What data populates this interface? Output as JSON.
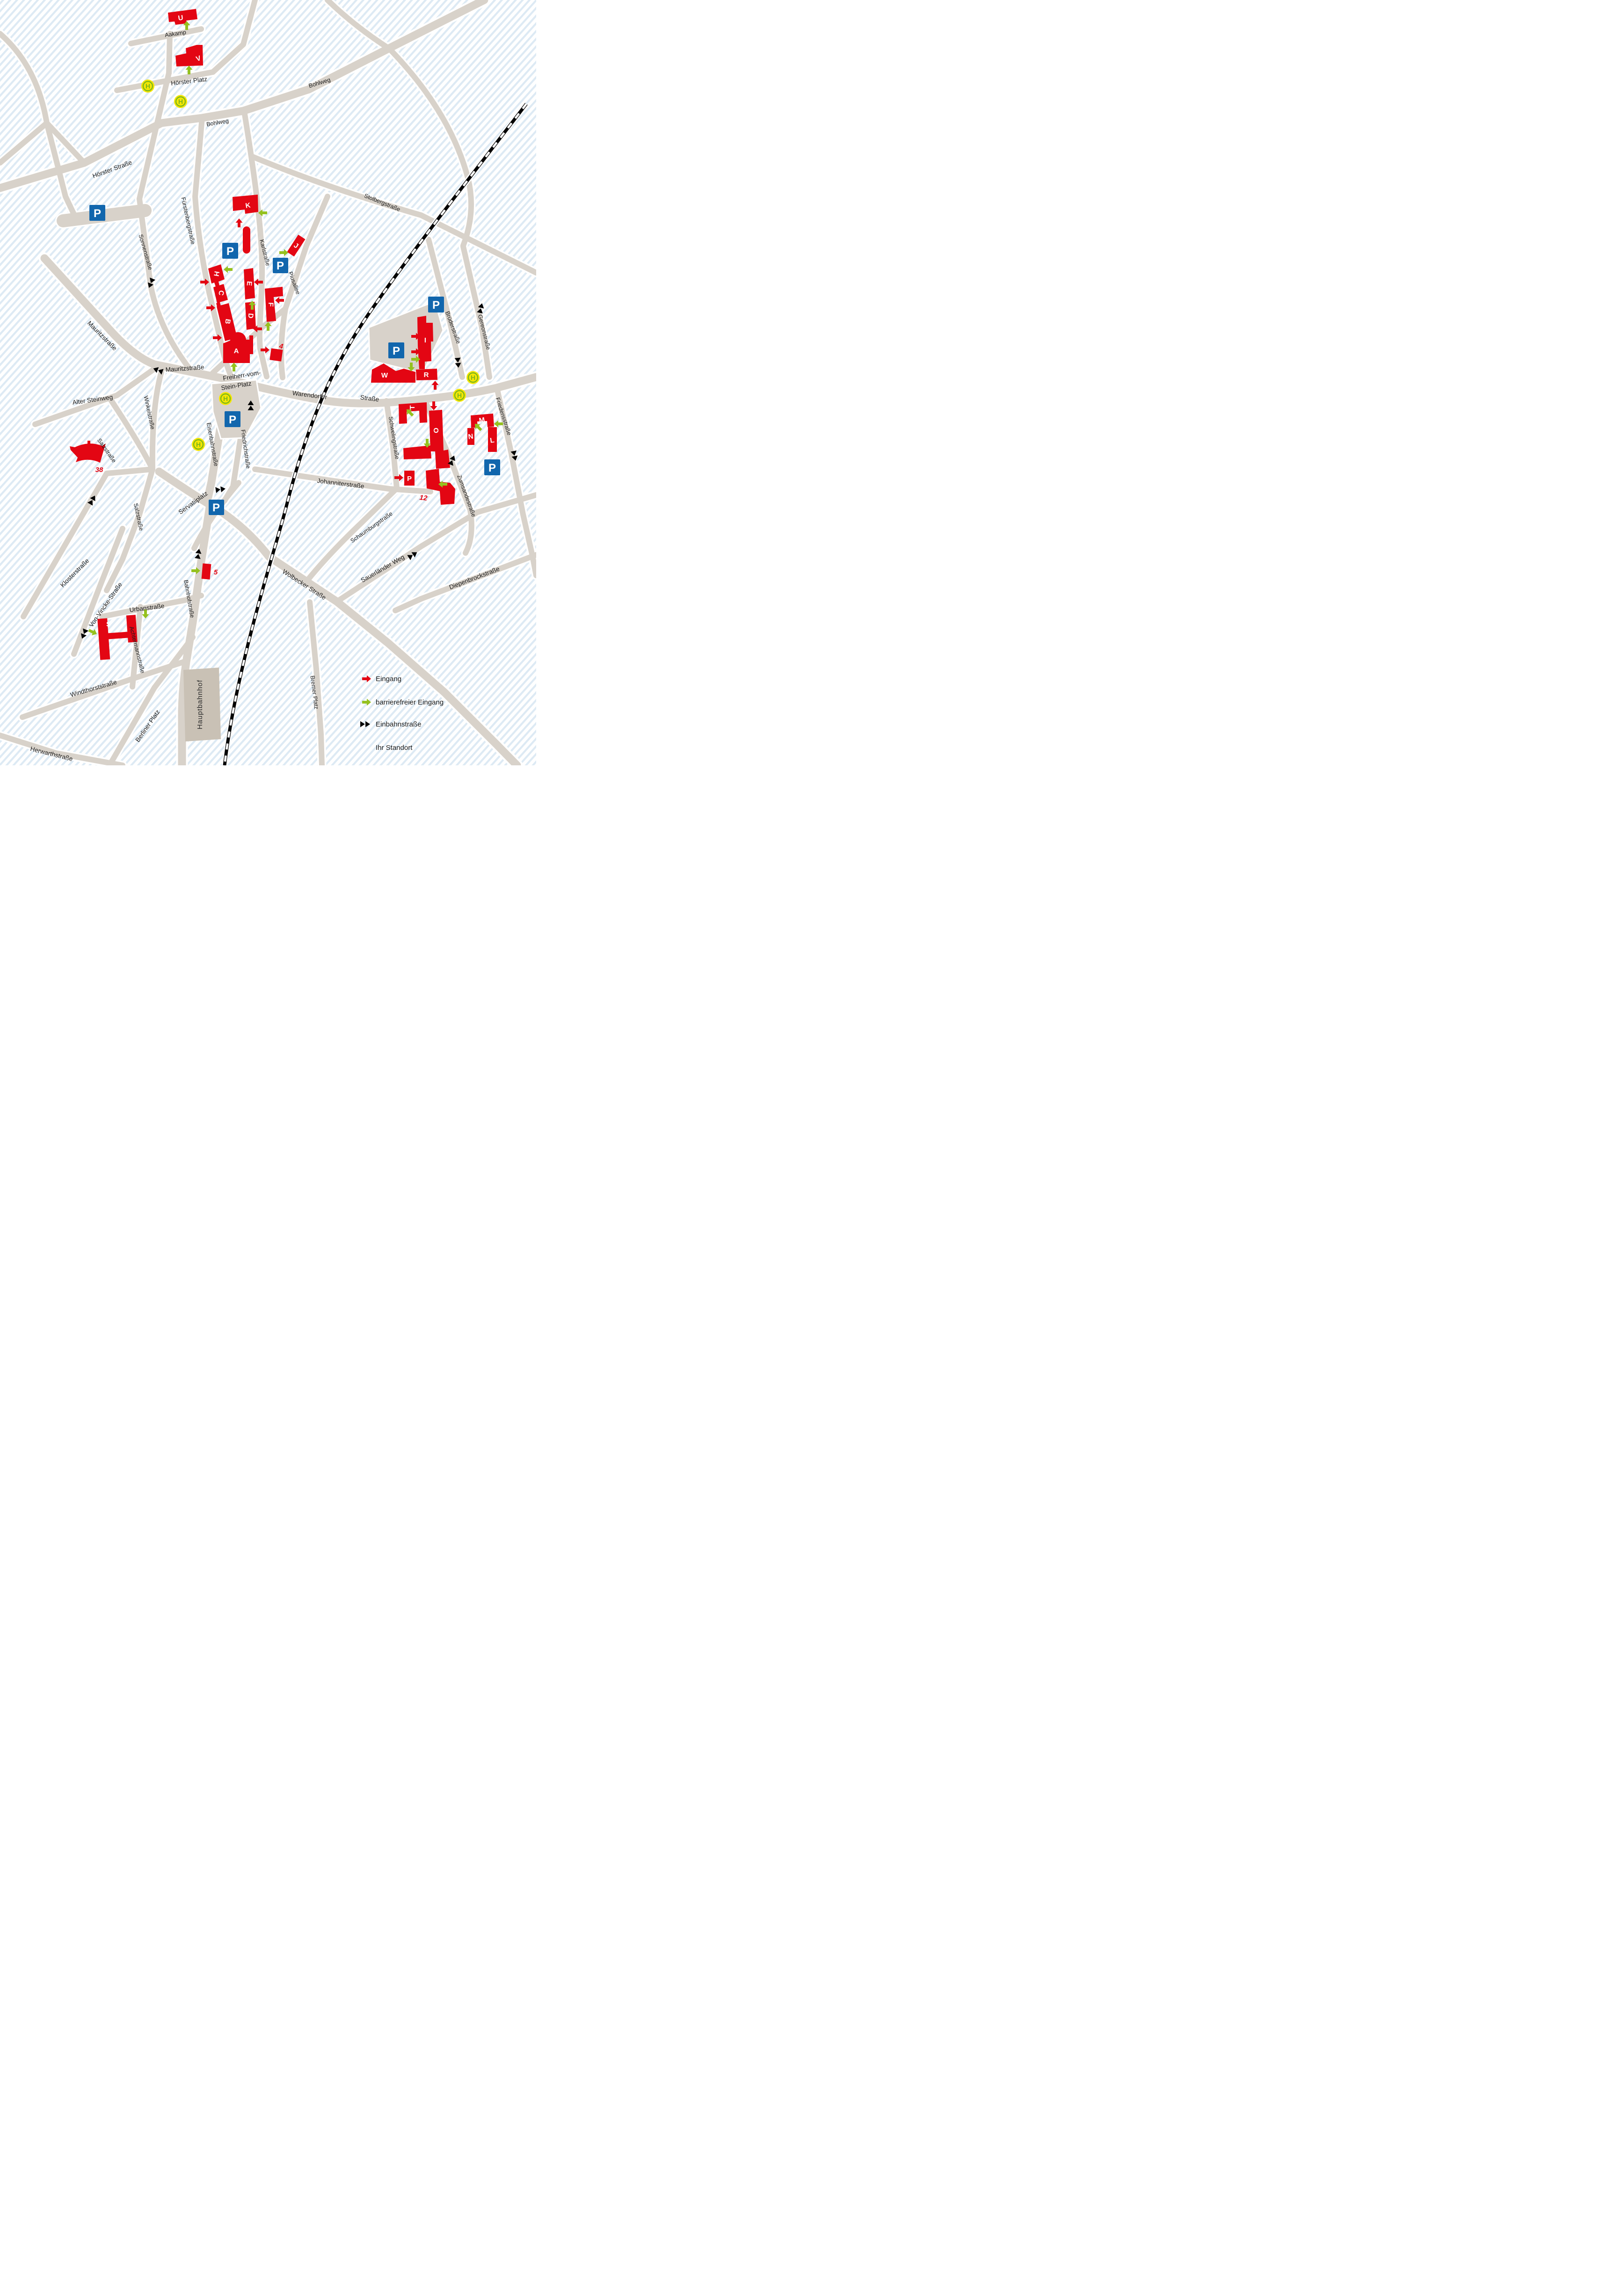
{
  "map": {
    "icons": {
      "parking_letter": "P",
      "stop_letter": "H"
    },
    "station": {
      "name": "Hauptbahnhof"
    },
    "legend": {
      "entrance": "Eingang",
      "accessible_entrance": "barrierefreier Eingang",
      "one_way": "Einbahnstraße",
      "location": "Ihr Standort"
    },
    "buildings": [
      {
        "label": "A"
      },
      {
        "label": "B"
      },
      {
        "label": "C"
      },
      {
        "label": "D"
      },
      {
        "label": "E"
      },
      {
        "label": "F"
      },
      {
        "label": "H"
      },
      {
        "label": "I"
      },
      {
        "label": "J"
      },
      {
        "label": "K"
      },
      {
        "label": "L"
      },
      {
        "label": "M"
      },
      {
        "label": "N"
      },
      {
        "label": "O"
      },
      {
        "label": "P"
      },
      {
        "label": "R"
      },
      {
        "label": "S"
      },
      {
        "label": "T"
      },
      {
        "label": "U"
      },
      {
        "label": "V"
      },
      {
        "label": "W"
      },
      {
        "label": "4"
      },
      {
        "label": "5"
      },
      {
        "label": "12"
      },
      {
        "label": "38"
      }
    ],
    "streets": [
      {
        "name": "Aakamp"
      },
      {
        "name": "Hörster Platz"
      },
      {
        "name": "Bohlweg"
      },
      {
        "name": "Hörster Straße"
      },
      {
        "name": "Sonnenstraße"
      },
      {
        "name": "Fürstenbergstraße"
      },
      {
        "name": "Karlstraße"
      },
      {
        "name": "Piusallee"
      },
      {
        "name": "Stolbergstraße"
      },
      {
        "name": "Mauritzstraße"
      },
      {
        "name": "Freiherr-vom-Stein-Platz",
        "line1": "Freiherr-vom-",
        "line2": "Stein-Platz"
      },
      {
        "name": "Warendorfer Straße",
        "part1": "Warendorfer",
        "part2": "Straße"
      },
      {
        "name": "Alter Steinweg"
      },
      {
        "name": "Winkelstraße"
      },
      {
        "name": "Salzstraße"
      },
      {
        "name": "Klosterstraße"
      },
      {
        "name": "Eisenbahnstraße"
      },
      {
        "name": "Friedrichstraße"
      },
      {
        "name": "Servatiiplatz"
      },
      {
        "name": "Bahnhofstraße"
      },
      {
        "name": "Von-Vincke-Straße"
      },
      {
        "name": "Urbanstraße"
      },
      {
        "name": "Achtermannstraße"
      },
      {
        "name": "Windthorststraße"
      },
      {
        "name": "Herwarthstraße"
      },
      {
        "name": "Berliner Platz"
      },
      {
        "name": "Wolbecker Straße"
      },
      {
        "name": "Bremer Platz"
      },
      {
        "name": "Brüderstraße"
      },
      {
        "name": "Gereonstraße"
      },
      {
        "name": "Friedensstraße"
      },
      {
        "name": "Schwelingstraße"
      },
      {
        "name": "Zumsandestraße"
      },
      {
        "name": "Johanniterstraße"
      },
      {
        "name": "Schaumburgstraße"
      },
      {
        "name": "Sauerländer Weg"
      },
      {
        "name": "Diepenbrockstraße"
      }
    ]
  }
}
